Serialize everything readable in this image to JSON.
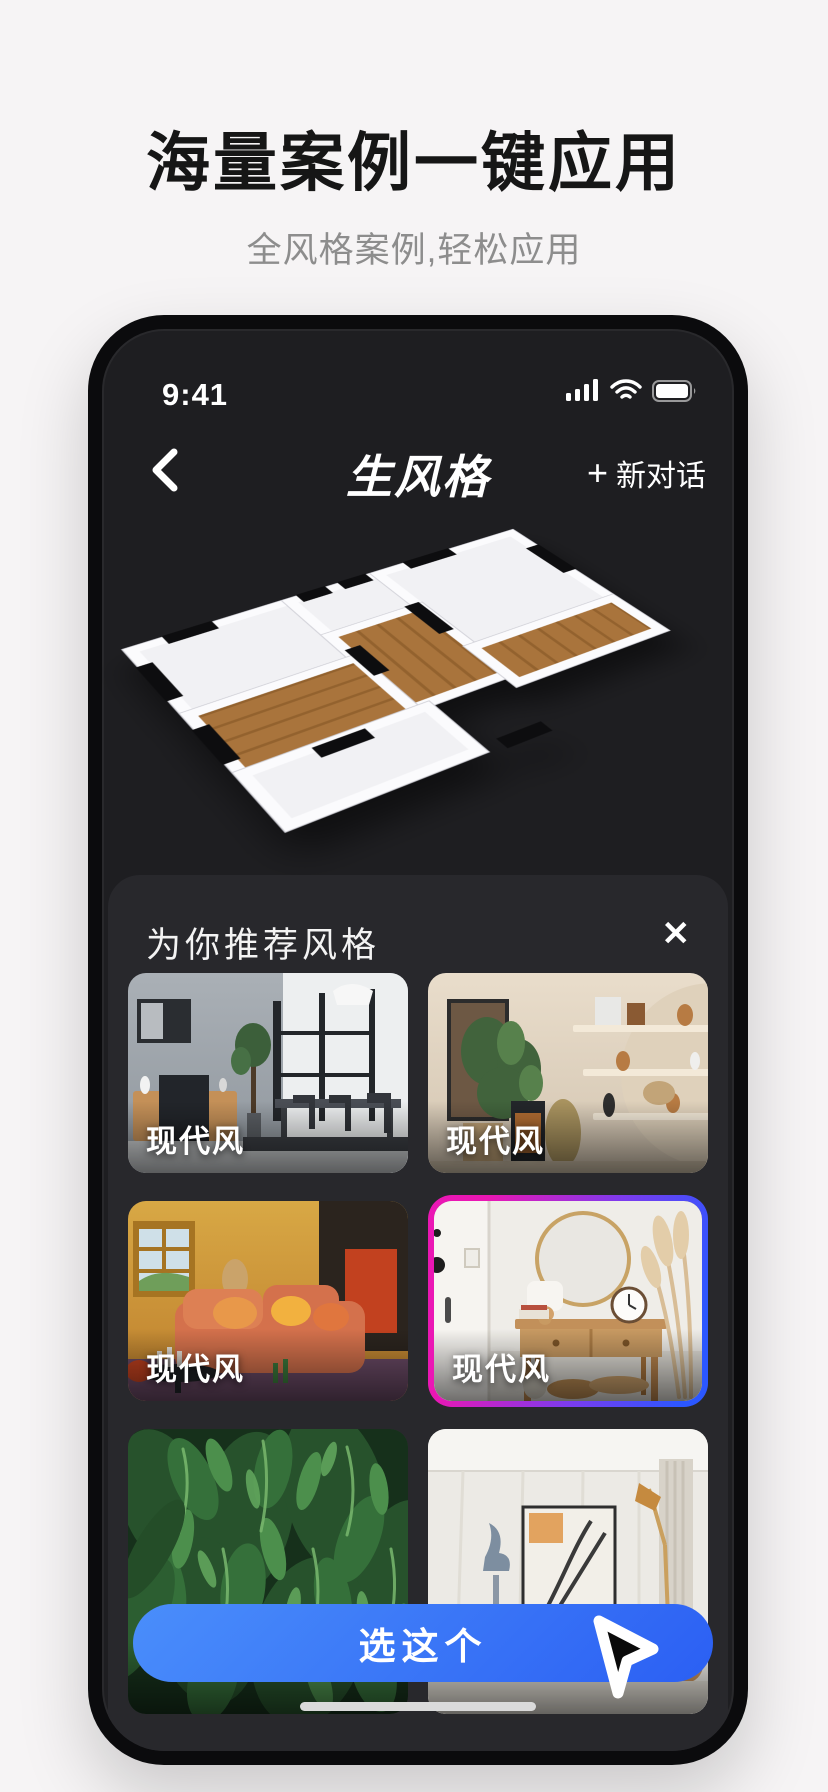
{
  "hero": {
    "title": "海量案例一键应用",
    "subtitle": "全风格案例,轻松应用"
  },
  "phone": {
    "status": {
      "time": "9:41"
    },
    "nav": {
      "title": "生风格",
      "new_chat": {
        "plus": "+",
        "label": "新对话"
      }
    },
    "sheet": {
      "title": "为你推荐风格",
      "close_icon": "✕",
      "cards": [
        {
          "label": "现代风",
          "selected": false,
          "photo": "modern-dining-gray"
        },
        {
          "label": "现代风",
          "selected": false,
          "photo": "modern-shelves-beige"
        },
        {
          "label": "现代风",
          "selected": false,
          "photo": "modern-sofa-orange"
        },
        {
          "label": "现代风",
          "selected": true,
          "photo": "modern-console-white"
        },
        {
          "label": "",
          "selected": false,
          "photo": "green-plant-wall"
        },
        {
          "label": "",
          "selected": false,
          "photo": "modern-living-beige"
        }
      ],
      "cta_label": "选这个"
    }
  },
  "colors": {
    "cta_gradient_start": "#4a8efb",
    "cta_gradient_end": "#2b5ff3",
    "selected_border_start": "#ea17b4",
    "selected_border_mid": "#7d3bee",
    "selected_border_end": "#2b57ff",
    "screen_background": "#1e1e21",
    "sheet_background": "#28282c",
    "page_background": "#f6f4f5"
  }
}
